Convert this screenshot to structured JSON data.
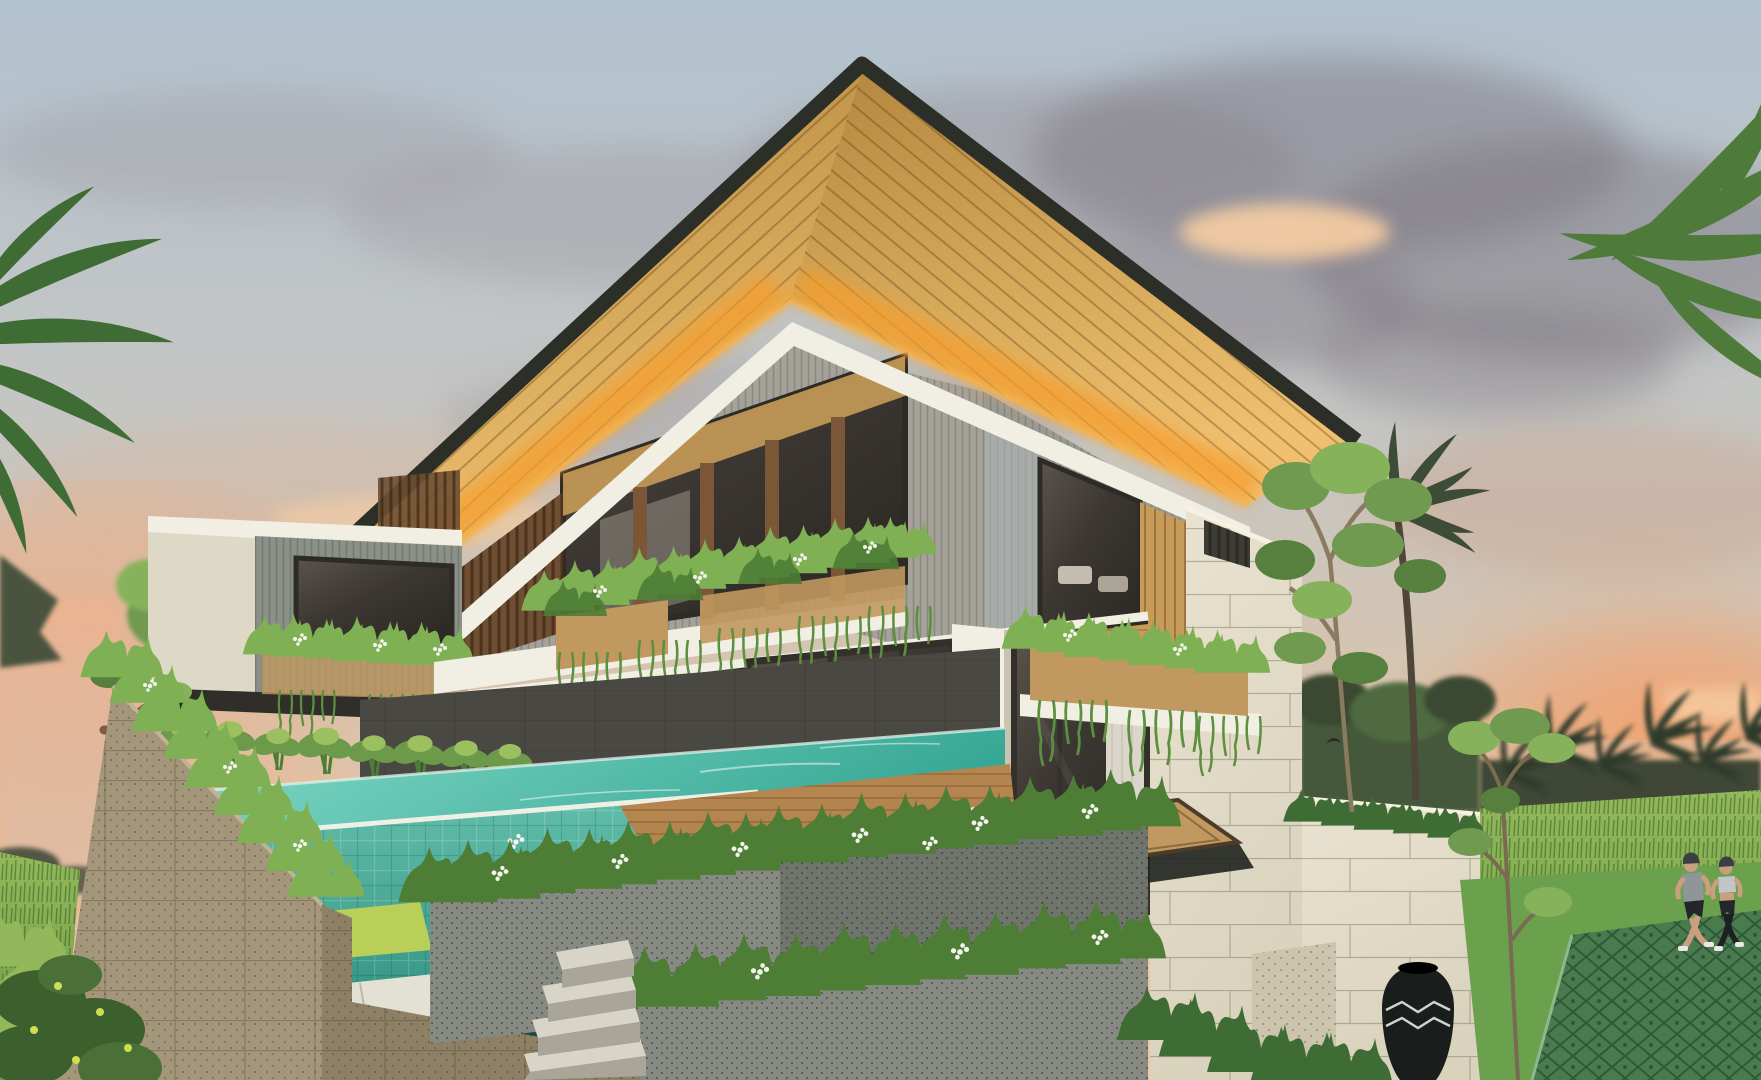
{
  "figures": {
    "joggers": 2,
    "birds": 1
  },
  "colors": {
    "sky_top": "#b2c2cf",
    "sky_mid": "#c7c6c2",
    "sky_warm": "#d8c3ac",
    "sky_horizon": "#eec4a2",
    "sunset_glow_left": "#f0ad85",
    "sunset_glow_right": "#f2a06d",
    "cloud_gray": "#978f96",
    "cloud_dark": "#7e7680",
    "cloud_lit": "#f7cda2",
    "haze_peach": "#ecb290",
    "roof_edge": "#2c2f27",
    "roof_wood": "#d8ab5c",
    "roof_wood_deep": "#b4873f",
    "roof_glow": "#f59e2f",
    "fascia_white": "#f1eee4",
    "wall_gray": "#a5a29a",
    "wall_blue": "#b3bdbe",
    "wing_slat": "#8b9189",
    "wing_cream": "#ded8c6",
    "louver_brown": "#6e4f33",
    "mullion_brown": "#7b5637",
    "window_glass": "#3c3733",
    "interior_wood": "#c79b58",
    "screen_brown": "#5f4227",
    "sofa_white": "#ddd5c4",
    "lamp_glow": "#ffd98f",
    "interior_floor": "#b08a52",
    "stone_dark": "#4a4843",
    "stone_beige": "#a3967a",
    "stone_beige_dark": "#8d8064",
    "planter_gray": "#868a82",
    "planter_gray_dark": "#6f746d",
    "paver_white": "#e3e0d4",
    "step_light": "#d8d5c8",
    "pool_light": "#86dcc9",
    "pool_deep": "#37a795",
    "pool_tile": "#63bfab",
    "pool_tile_deep": "#2e8d7c",
    "pool_lip": "#eef0e6",
    "lime_grass": "#b9cf57",
    "channel_dark": "#1d4a42",
    "plant_green": "#4e7d35",
    "plant_green_light": "#7fb054",
    "taro_green": "#6d9a4a",
    "hedge_dark": "#3f6b35",
    "vine_green": "#5c8f3e",
    "deck_tan": "#c1985f",
    "deck_wood": "#b4854e",
    "trunk_brown": "#7a5c42",
    "cream_wall": "#e9e3d1",
    "cream_wall_shade": "#d9d2bd",
    "rail_dark": "#3a3d38",
    "curtain": "#e9e4da",
    "field_green": "#6a9a40",
    "field_light": "#93b85c",
    "palm_dark": "#2f3b2b",
    "jungle_green": "#44583a",
    "tree_green": "#6f9a4f",
    "tree_green_light": "#86b25c",
    "drive_green": "#4a7b4e",
    "lawn_green": "#6ba04c",
    "vase_blue": "#3d4654",
    "pot_black": "#191d1c",
    "stone_white": "#ccc4ac",
    "skin": "#c99f80",
    "outfit_gray": "#8e9698",
    "outfit_light": "#c3c6c8",
    "outfit_dark": "#23262a",
    "shoe_white": "#e8e8e4",
    "white_flower": "#f4f4ee",
    "yellow_flower": "#cede52",
    "bird_dark": "#2e2a28"
  }
}
